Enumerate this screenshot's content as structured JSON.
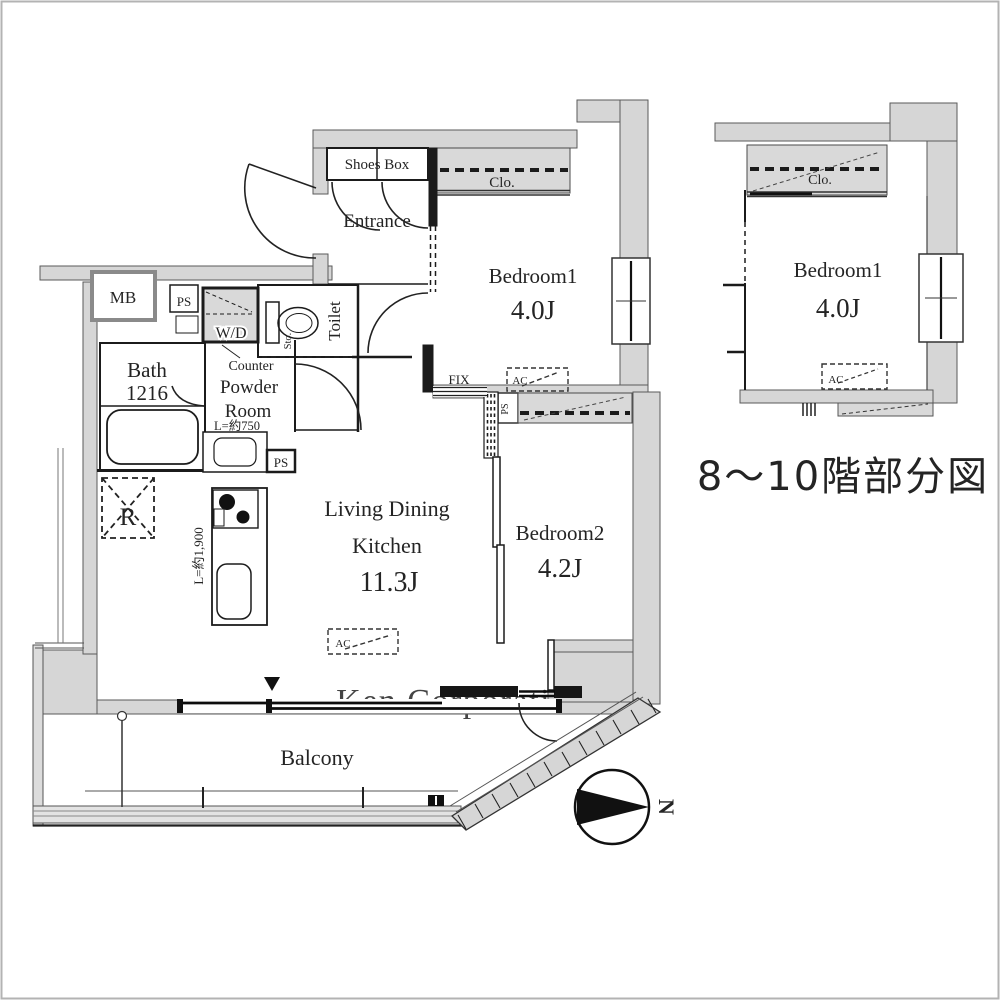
{
  "watermark": "Ken Corporation Ltd.",
  "colors": {
    "wall_fill": "#d6d6d6",
    "hatch_fill": "#d9d9d9",
    "line": "#1b1b1b",
    "text": "#242424",
    "watermark": "#c6c6c6"
  },
  "main_plan": {
    "shoes_box": "Shoes Box",
    "entrance": "Entrance",
    "closet": "Clo.",
    "bedroom1": {
      "name": "Bedroom1",
      "size": "4.0J"
    },
    "bedroom2": {
      "name": "Bedroom2",
      "size": "4.2J"
    },
    "ldk": {
      "line1": "Living Dining",
      "line2": "Kitchen",
      "size": "11.3J"
    },
    "bath": {
      "name": "Bath",
      "size": "1216"
    },
    "powder": {
      "counter": "Counter",
      "name1": "Powder",
      "name2": "Room",
      "width": "L=約750"
    },
    "toilet": "Toilet",
    "storage": "Sto.",
    "washer_dryer": "W/D",
    "meter_box": "MB",
    "pipe_space": "PS",
    "fridge": "R",
    "kitchen_width": "L=約1,900",
    "ac": "AC",
    "fix": "FIX",
    "balcony": "Balcony",
    "north": "N"
  },
  "partial_plan": {
    "caption": "8〜10階部分図",
    "closet": "Clo.",
    "bedroom1": {
      "name": "Bedroom1",
      "size": "4.0J"
    },
    "ac": "AC"
  }
}
